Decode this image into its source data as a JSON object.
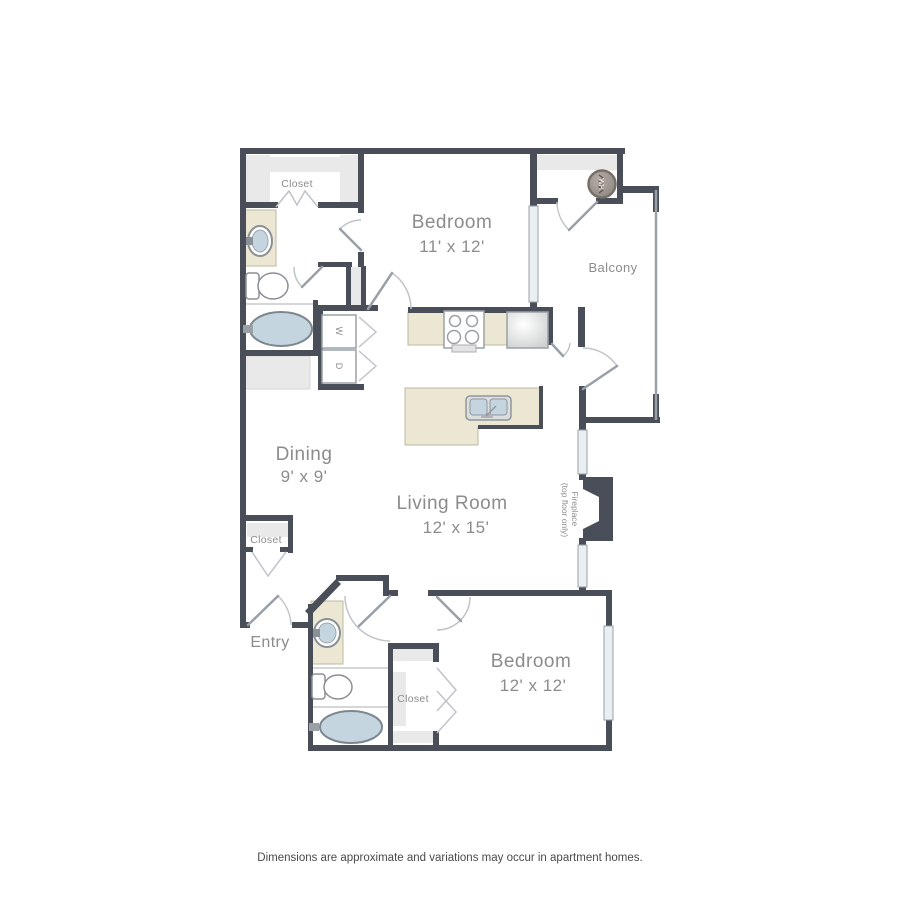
{
  "floorplan": {
    "rooms": [
      {
        "id": "bedroom1",
        "name": "Bedroom",
        "dims": "11' x 12'"
      },
      {
        "id": "bedroom2",
        "name": "Bedroom",
        "dims": "12' x 12'"
      },
      {
        "id": "living_room",
        "name": "Living Room",
        "dims": "12' x 15'"
      },
      {
        "id": "dining",
        "name": "Dining",
        "dims": "9' x 9'"
      },
      {
        "id": "balcony",
        "name": "Balcony"
      },
      {
        "id": "entry",
        "name": "Entry"
      }
    ],
    "closets": {
      "top": "Closet",
      "middle": "Closet",
      "bottom": "Closet"
    },
    "appliances": {
      "washer": "W",
      "dryer": "D",
      "water_heater": "WH"
    },
    "fireplace": {
      "line1": "Fireplace",
      "line2": "(top floor only)"
    },
    "icons": [
      "stove-icon",
      "fridge-icon",
      "island-sink-icon",
      "bathtub-icon",
      "toilet-icon",
      "sink-icon",
      "water-heater-icon"
    ],
    "colors": {
      "wall": "#494e58",
      "counter": "#ebe7d3",
      "fixture_blue": "#c5d5df",
      "shading": "#e9e9e9",
      "window": "#eaeff2",
      "label": "#8c8c8c",
      "door_arc": "#c0c4c9",
      "footer": "#4a4a4a"
    }
  },
  "footer": {
    "disclaimer": "Dimensions are approximate and variations may occur in apartment homes."
  }
}
